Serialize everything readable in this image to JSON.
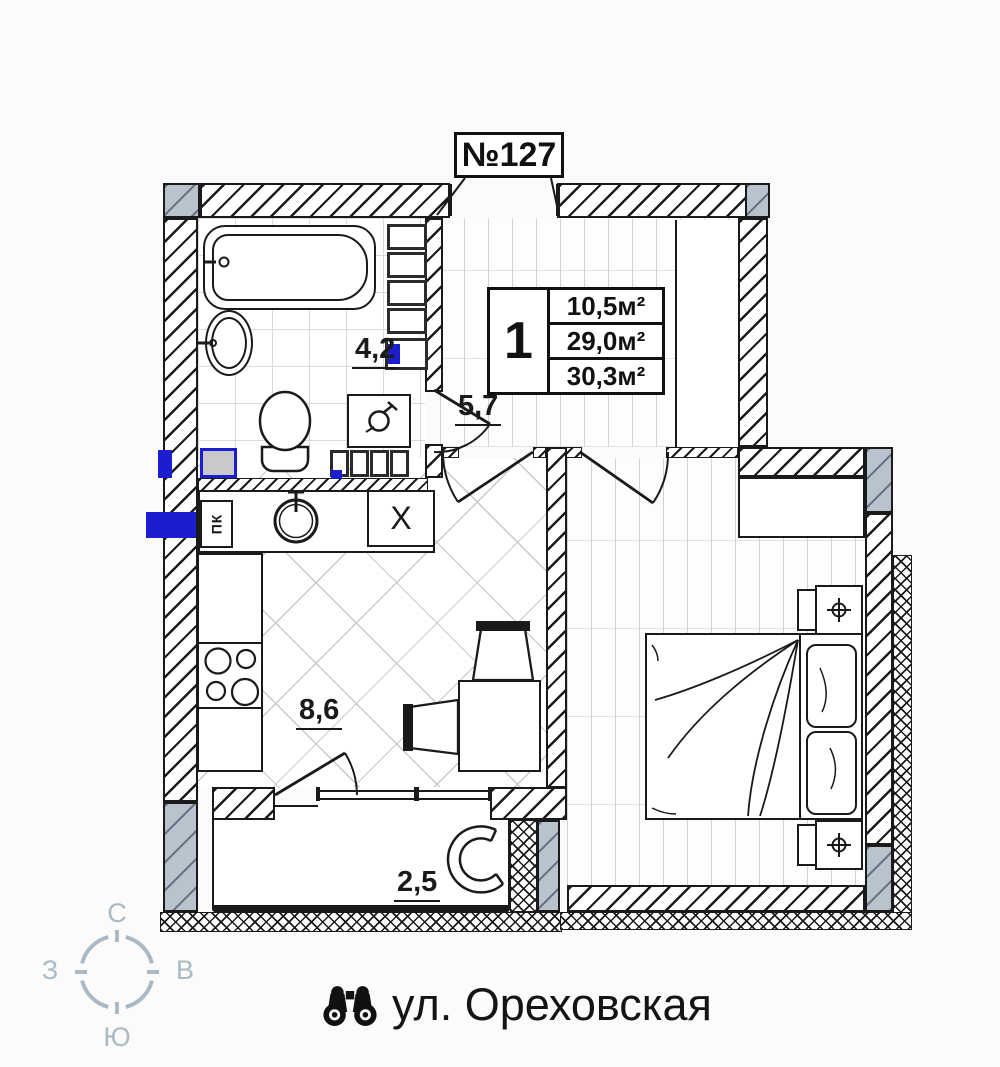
{
  "unit": {
    "number": "№127"
  },
  "info_box": {
    "room_count": "1",
    "areas": [
      "10,5м²",
      "29,0м²",
      "30,3м²"
    ]
  },
  "room_labels": {
    "bathroom": "4,2",
    "hallway": "5,7",
    "kitchen_living": "8,6",
    "balcony": "2,5"
  },
  "kitchen": {
    "stove_box_label": "ПК",
    "cabinet_label": "X"
  },
  "compass": {
    "north": "С",
    "east": "В",
    "south": "Ю",
    "west": "З"
  },
  "address": {
    "street": "ул. Ореховская",
    "icon": "binoculars-icon"
  },
  "colors": {
    "line": "#1a1a1a",
    "accent_blue": "#1d1dd0",
    "glazing_gray": "#b9c3cd",
    "compass_gray": "#a9bac7",
    "background": "#fcfbf9"
  }
}
